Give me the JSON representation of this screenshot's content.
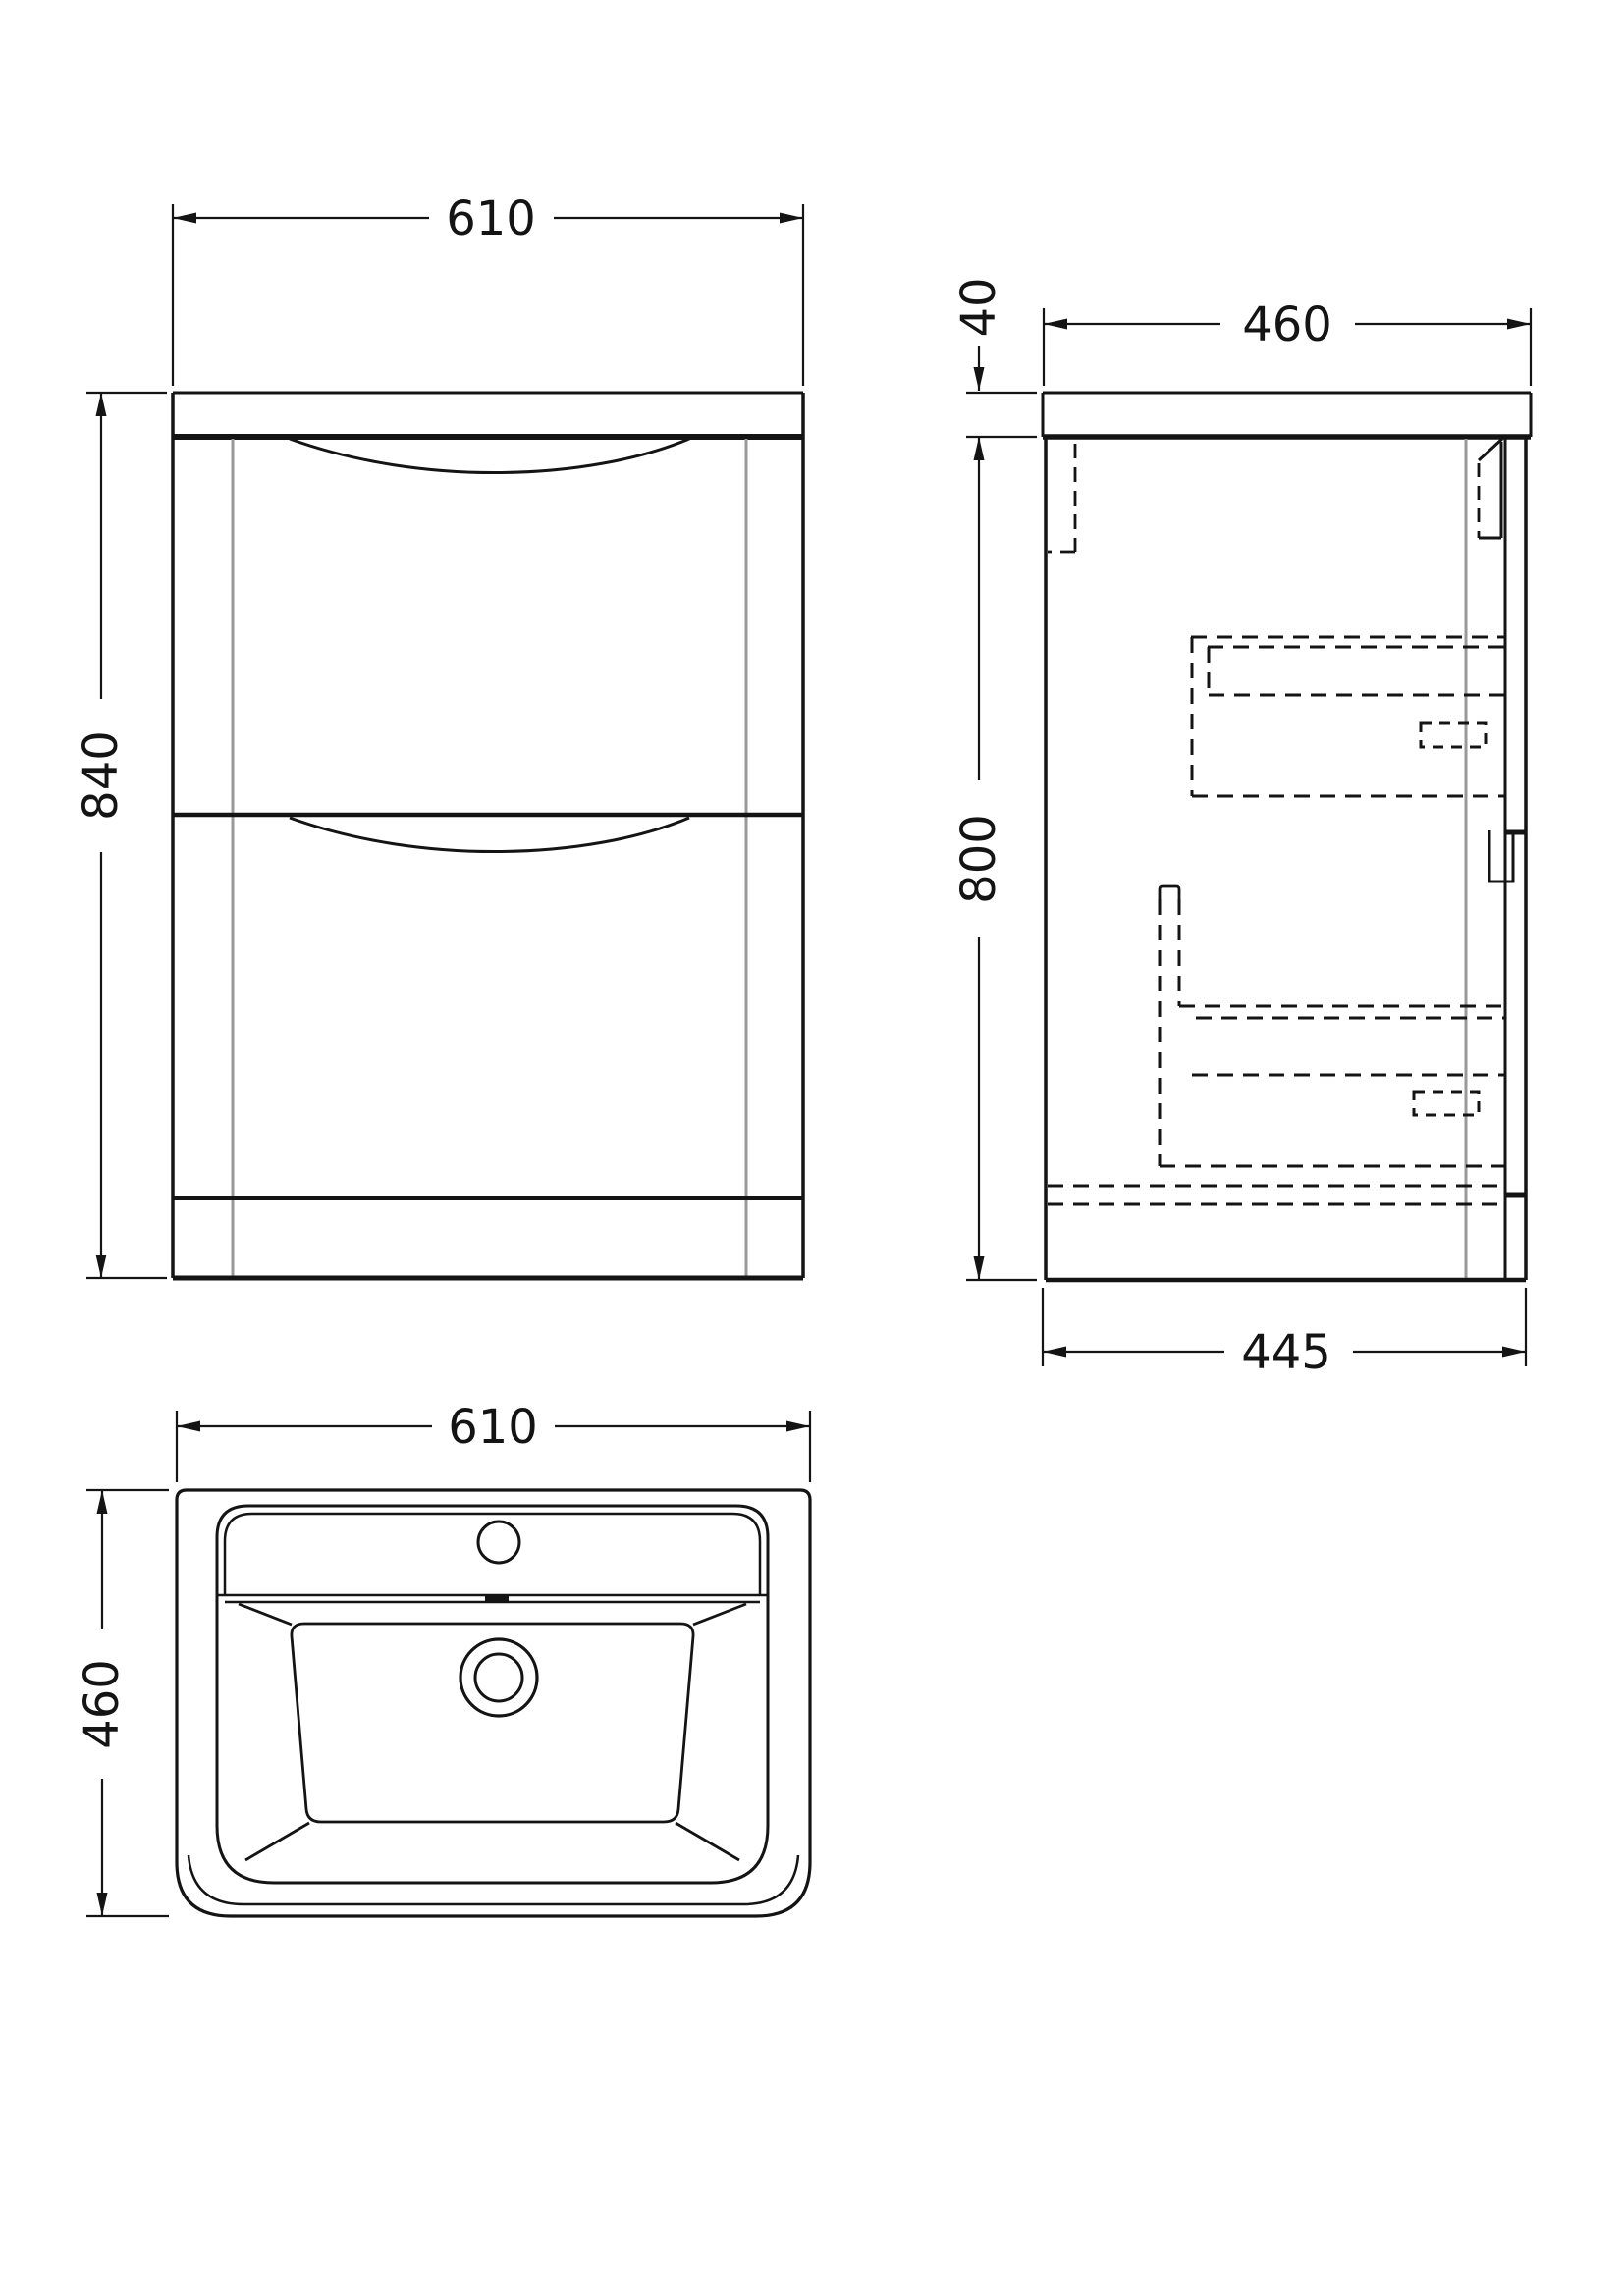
{
  "views": {
    "front": {
      "width": "610",
      "height": "840"
    },
    "side": {
      "countertop_thickness": "40",
      "depth": "460",
      "height": "800",
      "base_depth": "445"
    },
    "basin_plan": {
      "width": "610",
      "depth": "460"
    }
  },
  "colors": {
    "line": "#141414",
    "seam_line": "#999999",
    "hidden_line": "#141414",
    "background": "#ffffff"
  }
}
